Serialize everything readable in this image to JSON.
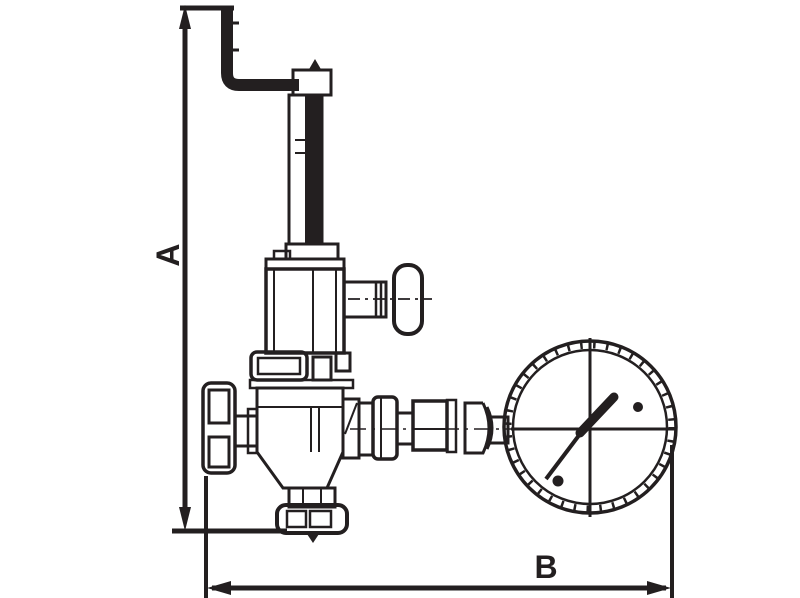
{
  "diagram": {
    "subject": "line drawing of a safety relief valve with side handwheel and pressure gauge",
    "labels": {
      "vertical_dimension": "A",
      "horizontal_dimension": "B"
    }
  },
  "colors": {
    "line": "#231F20",
    "background": "#FFFFFF"
  }
}
